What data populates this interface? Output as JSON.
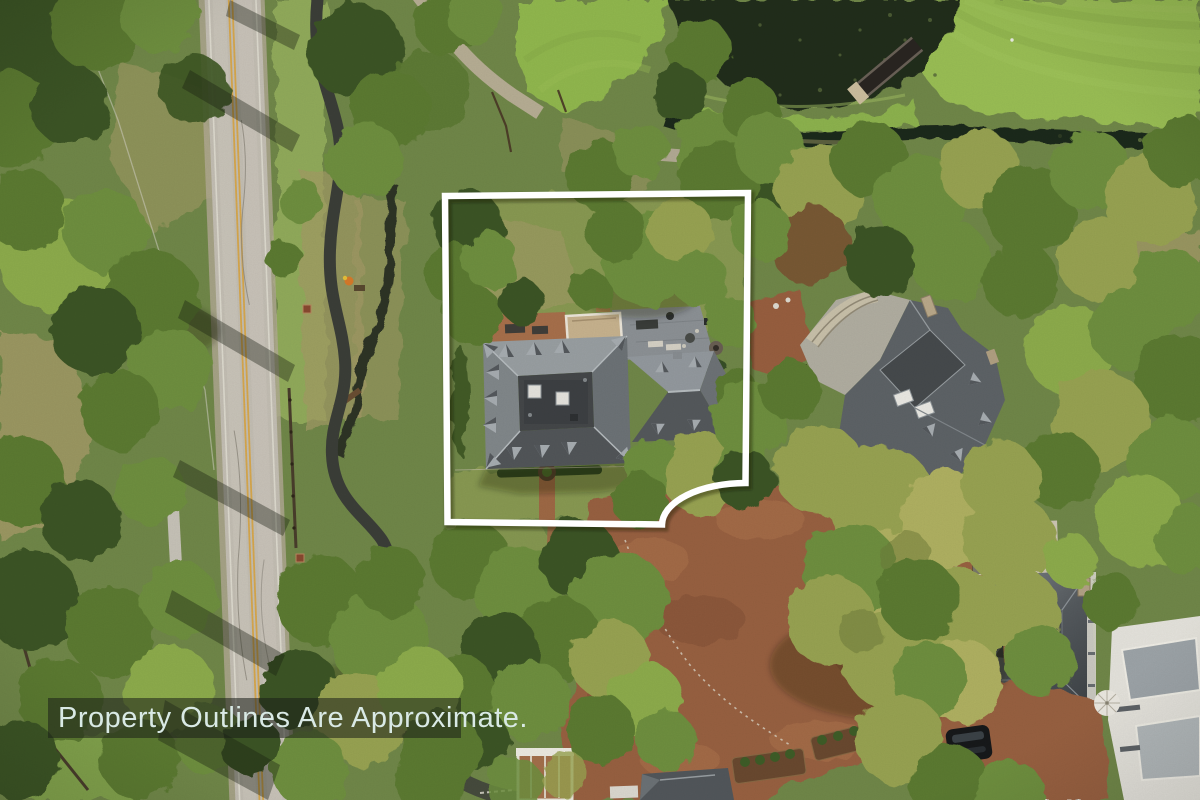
{
  "banner": {
    "text": "Property Outlines Are Approximate.",
    "background_color": "rgba(25,30,24,0.55)",
    "text_color": "#d9e9e5"
  },
  "overlay": {
    "outline_color": "#ffffff",
    "outline_shadow": "rgba(20,25,15,0.4)"
  },
  "scene": {
    "palette": {
      "golf_green": "#9cc157",
      "pond_water": "#232d1e",
      "road_asphalt": "#c6c1b6",
      "road_center_line": "#d9a94e",
      "brick_paving": "#9a6243",
      "slate_roof_light": "#9ba1a4",
      "slate_roof_dark": "#54585b",
      "tree_canopy": "#5d7b33",
      "lawn": "#8a9b53"
    }
  }
}
